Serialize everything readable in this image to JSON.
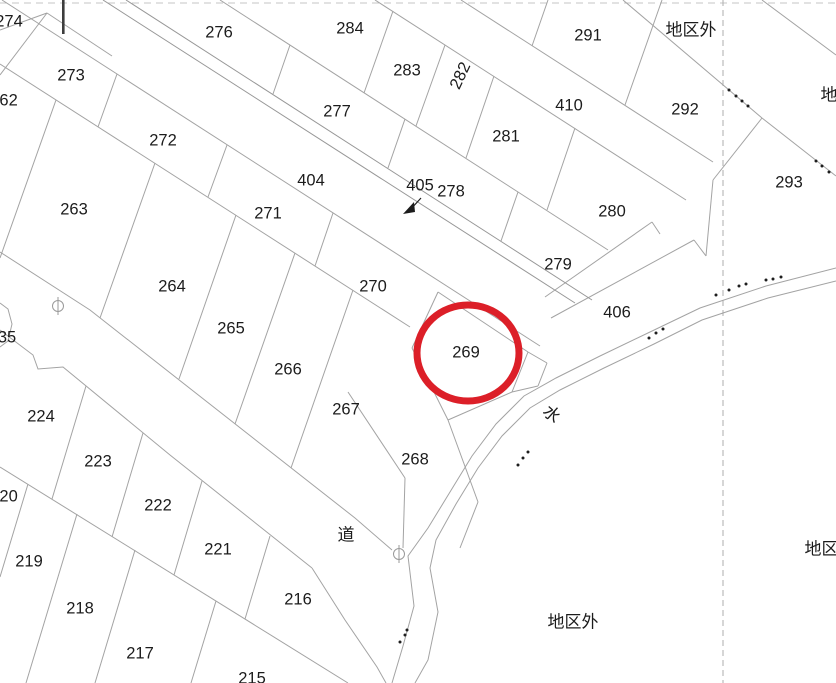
{
  "map": {
    "title": "cadastral-parcel-map",
    "highlight": {
      "cx": 468,
      "cy": 353,
      "rx": 51,
      "ry": 48,
      "color": "#dc1f28",
      "stroke_width": 7,
      "parcel": "269"
    },
    "labels": [
      {
        "text": "274",
        "x": 9,
        "y": 22
      },
      {
        "text": "276",
        "x": 219,
        "y": 33
      },
      {
        "text": "284",
        "x": 350,
        "y": 29
      },
      {
        "text": "283",
        "x": 407,
        "y": 71
      },
      {
        "text": "282",
        "x": 461,
        "y": 76,
        "rot": -65
      },
      {
        "text": "291",
        "x": 588,
        "y": 36
      },
      {
        "text": "地区外",
        "x": 691,
        "y": 31,
        "kind": "area"
      },
      {
        "text": "273",
        "x": 71,
        "y": 76
      },
      {
        "text": "地区外",
        "x": 846,
        "y": 96,
        "kind": "area"
      },
      {
        "text": "292",
        "x": 685,
        "y": 110
      },
      {
        "text": "410",
        "x": 569,
        "y": 106
      },
      {
        "text": "262",
        "x": 4,
        "y": 101
      },
      {
        "text": "272",
        "x": 163,
        "y": 141
      },
      {
        "text": "277",
        "x": 337,
        "y": 112
      },
      {
        "text": "281",
        "x": 506,
        "y": 137
      },
      {
        "text": "404",
        "x": 311,
        "y": 181
      },
      {
        "text": "405",
        "x": 420,
        "y": 186
      },
      {
        "text": "278",
        "x": 451,
        "y": 192
      },
      {
        "text": "293",
        "x": 789,
        "y": 183
      },
      {
        "text": "263",
        "x": 74,
        "y": 210
      },
      {
        "text": "271",
        "x": 268,
        "y": 214
      },
      {
        "text": "280",
        "x": 612,
        "y": 212
      },
      {
        "text": "279",
        "x": 558,
        "y": 265
      },
      {
        "text": "264",
        "x": 172,
        "y": 287
      },
      {
        "text": "270",
        "x": 373,
        "y": 287
      },
      {
        "text": "406",
        "x": 617,
        "y": 313
      },
      {
        "text": "265",
        "x": 231,
        "y": 329
      },
      {
        "text": "35",
        "x": 7,
        "y": 338
      },
      {
        "text": "269",
        "x": 466,
        "y": 353
      },
      {
        "text": "266",
        "x": 288,
        "y": 370
      },
      {
        "text": "267",
        "x": 346,
        "y": 410
      },
      {
        "text": "水",
        "x": 551,
        "y": 415,
        "rot": 42,
        "kind": "water"
      },
      {
        "text": "224",
        "x": 41,
        "y": 417
      },
      {
        "text": "268",
        "x": 415,
        "y": 460
      },
      {
        "text": "223",
        "x": 98,
        "y": 462
      },
      {
        "text": "220",
        "x": 4,
        "y": 497
      },
      {
        "text": "222",
        "x": 158,
        "y": 506
      },
      {
        "text": "道",
        "x": 346,
        "y": 536,
        "kind": "road"
      },
      {
        "text": "221",
        "x": 218,
        "y": 550
      },
      {
        "text": "地区外",
        "x": 830,
        "y": 550,
        "kind": "area"
      },
      {
        "text": "219",
        "x": 29,
        "y": 562
      },
      {
        "text": "216",
        "x": 298,
        "y": 600
      },
      {
        "text": "218",
        "x": 80,
        "y": 609
      },
      {
        "text": "地区外",
        "x": 573,
        "y": 623,
        "kind": "area"
      },
      {
        "text": "217",
        "x": 140,
        "y": 654
      },
      {
        "text": "215",
        "x": 252,
        "y": 679
      }
    ],
    "survey_markers": [
      {
        "x": 58,
        "y": 306
      },
      {
        "x": 399,
        "y": 554
      }
    ],
    "arrow_405": {
      "x1": 421,
      "y1": 198,
      "x2": 410,
      "y2": 210
    }
  }
}
